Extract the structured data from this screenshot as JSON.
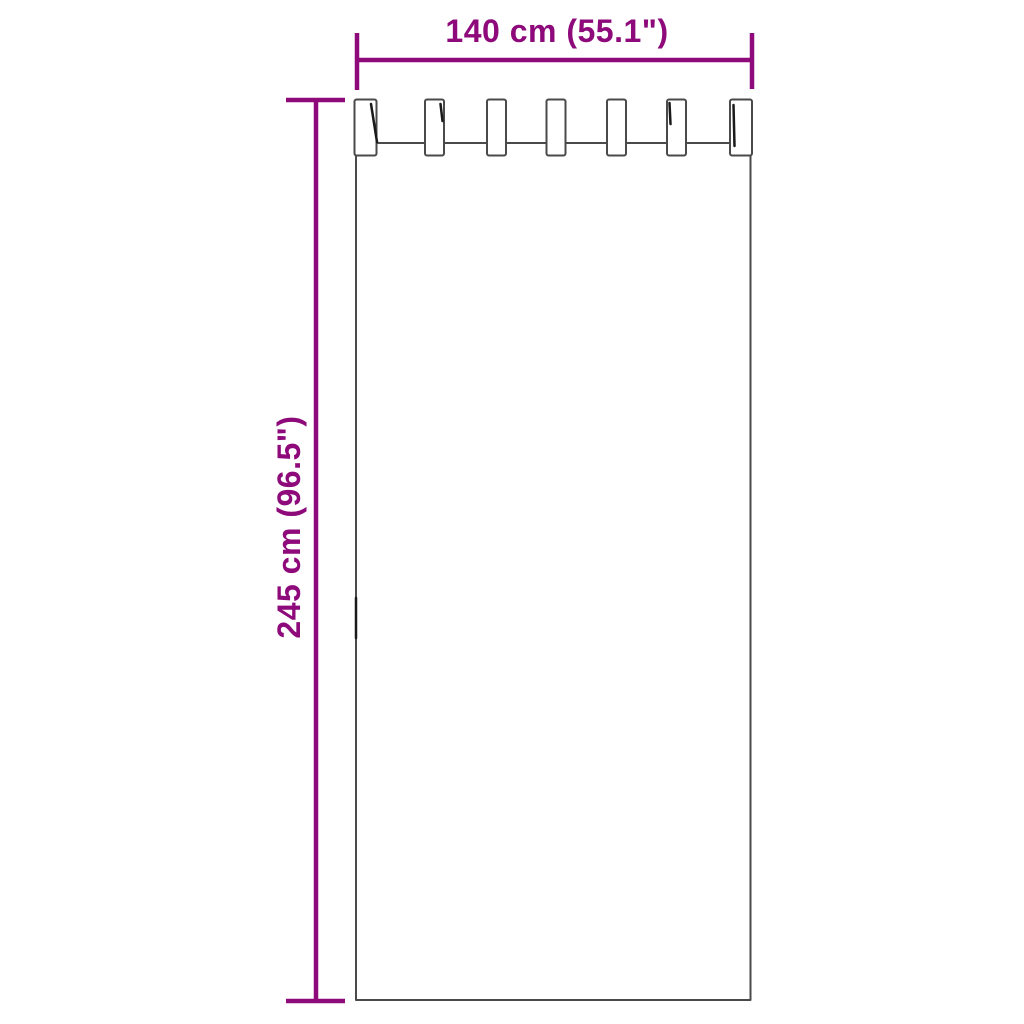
{
  "page": {
    "background": "#ffffff"
  },
  "colors": {
    "accent": "#8e0a7b",
    "outline": "#4a4a4a",
    "shading": "#1a1a1a"
  },
  "diagram": {
    "type": "product-dimension-diagram",
    "subject": "tab-top curtain panel",
    "tab_count": 7,
    "dimensions": {
      "width": {
        "label": "140 cm (55.1\")",
        "cm": 140,
        "inches": 55.1
      },
      "height": {
        "label": "245 cm (96.5\")",
        "cm": 245,
        "inches": 96.5
      }
    }
  }
}
